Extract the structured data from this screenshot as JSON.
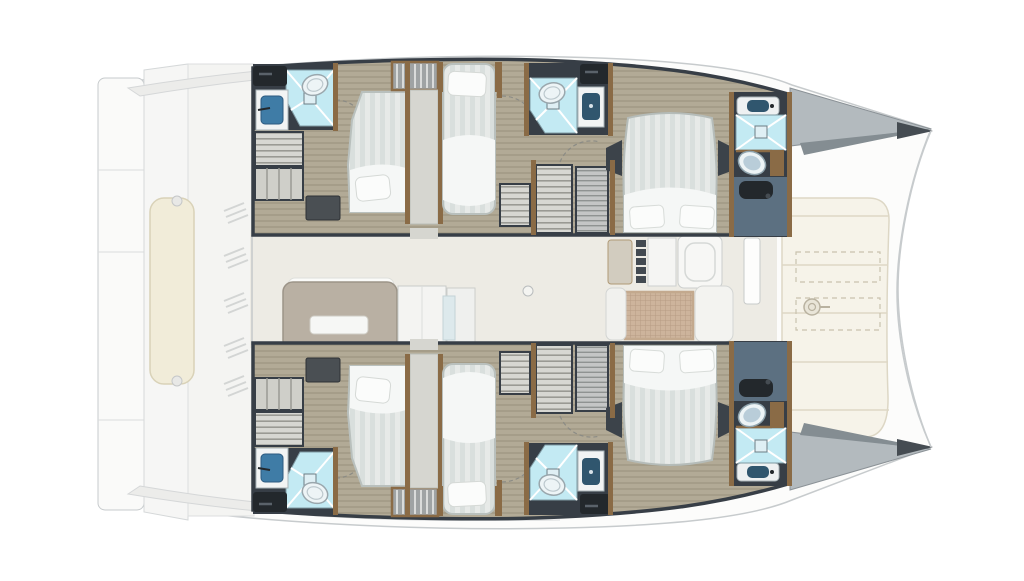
{
  "title": "Catamaran interior layout floor plan (top view, bows to the right)",
  "diagram_type": "yacht-floor-plan",
  "palette": {
    "bg": "#ffffff",
    "hull_line": "#c7cbcd",
    "hull_fill": "#fcfcfb",
    "deck_band": "#ececea",
    "deck_gray": "#b3babe",
    "deck_shade": "#848d92",
    "deck_dark": "#454c52",
    "wall": "#373e46",
    "wood": "#8a6b46",
    "cabin_floor": "#b2aa96",
    "saloon_floor": "#edebe4",
    "bed_linen": "#e7eae8",
    "bed_stripe": "#d9dfdd",
    "sheet": "#f5f7f6",
    "pillow": "#fbfcfb",
    "shower": "#c3eaf3",
    "shower_line": "#ffffff",
    "toilet": "#edf4f6",
    "toilet_lid": "#b9cdd9",
    "sink_blue": "#3f7ca6",
    "basin_dark": "#30566e",
    "counter_black": "#23282c",
    "slate": "#5c7081",
    "cushion": "#f6f3e9",
    "cushion_line": "#ddd7c5",
    "bench_cream": "#f1ecd9",
    "mesh": "#cdb49c",
    "mesh_line": "#b69c84",
    "galley_taupe": "#b9b0a3",
    "white_furniture": "#f4f4f2",
    "shelf": "#d7d7d2",
    "shelf_line": "#9a9a94",
    "corridor": "#d6d6d0"
  },
  "layout": {
    "orientation": "bow-right",
    "counts": {
      "double_beds": 4,
      "single_berths": 2,
      "wet_rooms": 6,
      "companionways": 2
    },
    "hulls": [
      {
        "name": "port-hull",
        "position": "top",
        "rooms": [
          {
            "name": "aft-head",
            "fixtures": [
              "shower-pan",
              "toilet",
              "sink",
              "black-counter"
            ]
          },
          {
            "name": "aft-storage",
            "fixtures": [
              "shelf-unit",
              "locker",
              "dark-cabinet"
            ]
          },
          {
            "name": "aft-cabin",
            "fixtures": [
              "double-bed",
              "pillow"
            ]
          },
          {
            "name": "companionway",
            "fixtures": [
              "stairs",
              "corridor"
            ]
          },
          {
            "name": "single-berth-cabin",
            "fixtures": [
              "single-bed",
              "pillow",
              "shelf-unit"
            ]
          },
          {
            "name": "mid-head",
            "fixtures": [
              "shower-pan",
              "toilet",
              "sink",
              "black-counter"
            ]
          },
          {
            "name": "wardrobes",
            "fixtures": [
              "shelf-unit",
              "hanging-locker"
            ]
          },
          {
            "name": "forward-cabin",
            "fixtures": [
              "island-double-bed",
              "two-pillows",
              "nightstands"
            ]
          },
          {
            "name": "forward-head",
            "fixtures": [
              "vanity-sink",
              "shower-pan",
              "toilet",
              "slate-vanity"
            ]
          }
        ]
      },
      {
        "name": "starboard-hull",
        "position": "bottom",
        "mirror_of": "port-hull"
      }
    ],
    "saloon": {
      "features": [
        "galley-island-with-sink",
        "fridge-cabinets",
        "nav-seat",
        "cooktop-knobs",
        "galley-counter-sink",
        "dining-table-rattan-top",
        "white-settees",
        "mast-post",
        "deck-fitting-circle"
      ]
    },
    "aft_deck": {
      "features": [
        "twin-transom-platforms",
        "transom-steps",
        "hardtop-edge-top",
        "hardtop-edge-bottom",
        "cockpit-bench-cream",
        "deck-vent-hatching"
      ]
    },
    "foredeck": {
      "features": [
        "sun-lounge-cushions",
        "cushion-seams",
        "hatch-outlines-dashed",
        "windlass",
        "port-bow-deck-wedge",
        "starboard-bow-deck-wedge"
      ]
    }
  }
}
